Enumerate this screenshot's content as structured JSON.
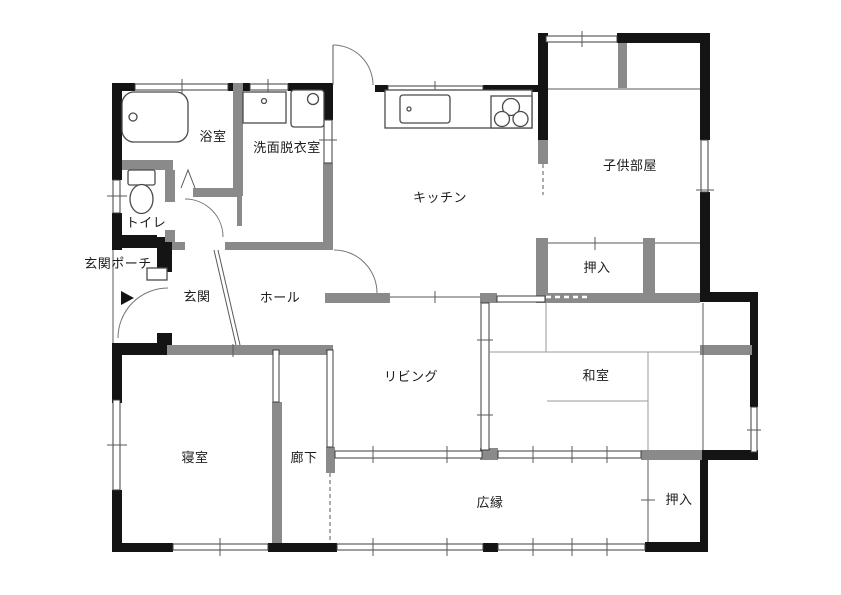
{
  "figure": {
    "type": "floor-plan",
    "style": "japanese-madori"
  },
  "rooms": [
    {
      "id": "bathroom",
      "label": "浴室"
    },
    {
      "id": "washroom",
      "label": "洗面脱衣室"
    },
    {
      "id": "toilet",
      "label": "トイレ"
    },
    {
      "id": "entrance-porch",
      "label": "玄関ポーチ"
    },
    {
      "id": "entrance",
      "label": "玄関"
    },
    {
      "id": "hall",
      "label": "ホール"
    },
    {
      "id": "kitchen",
      "label": "キッチン"
    },
    {
      "id": "kids-room",
      "label": "子供部屋"
    },
    {
      "id": "closet-upper",
      "label": "押入"
    },
    {
      "id": "living",
      "label": "リビング"
    },
    {
      "id": "japanese-room",
      "label": "和室"
    },
    {
      "id": "bedroom",
      "label": "寝室"
    },
    {
      "id": "corridor",
      "label": "廊下"
    },
    {
      "id": "veranda",
      "label": "広縁"
    },
    {
      "id": "closet-lower",
      "label": "押入"
    }
  ],
  "icons": {
    "entrance_arrow": "right-filled-triangle"
  },
  "colors": {
    "wall_exterior": "#141414",
    "wall_interior": "#8a8a8a",
    "line": "#5a5a5a",
    "tatami_line": "#9a9a9a",
    "background": "#ffffff"
  }
}
